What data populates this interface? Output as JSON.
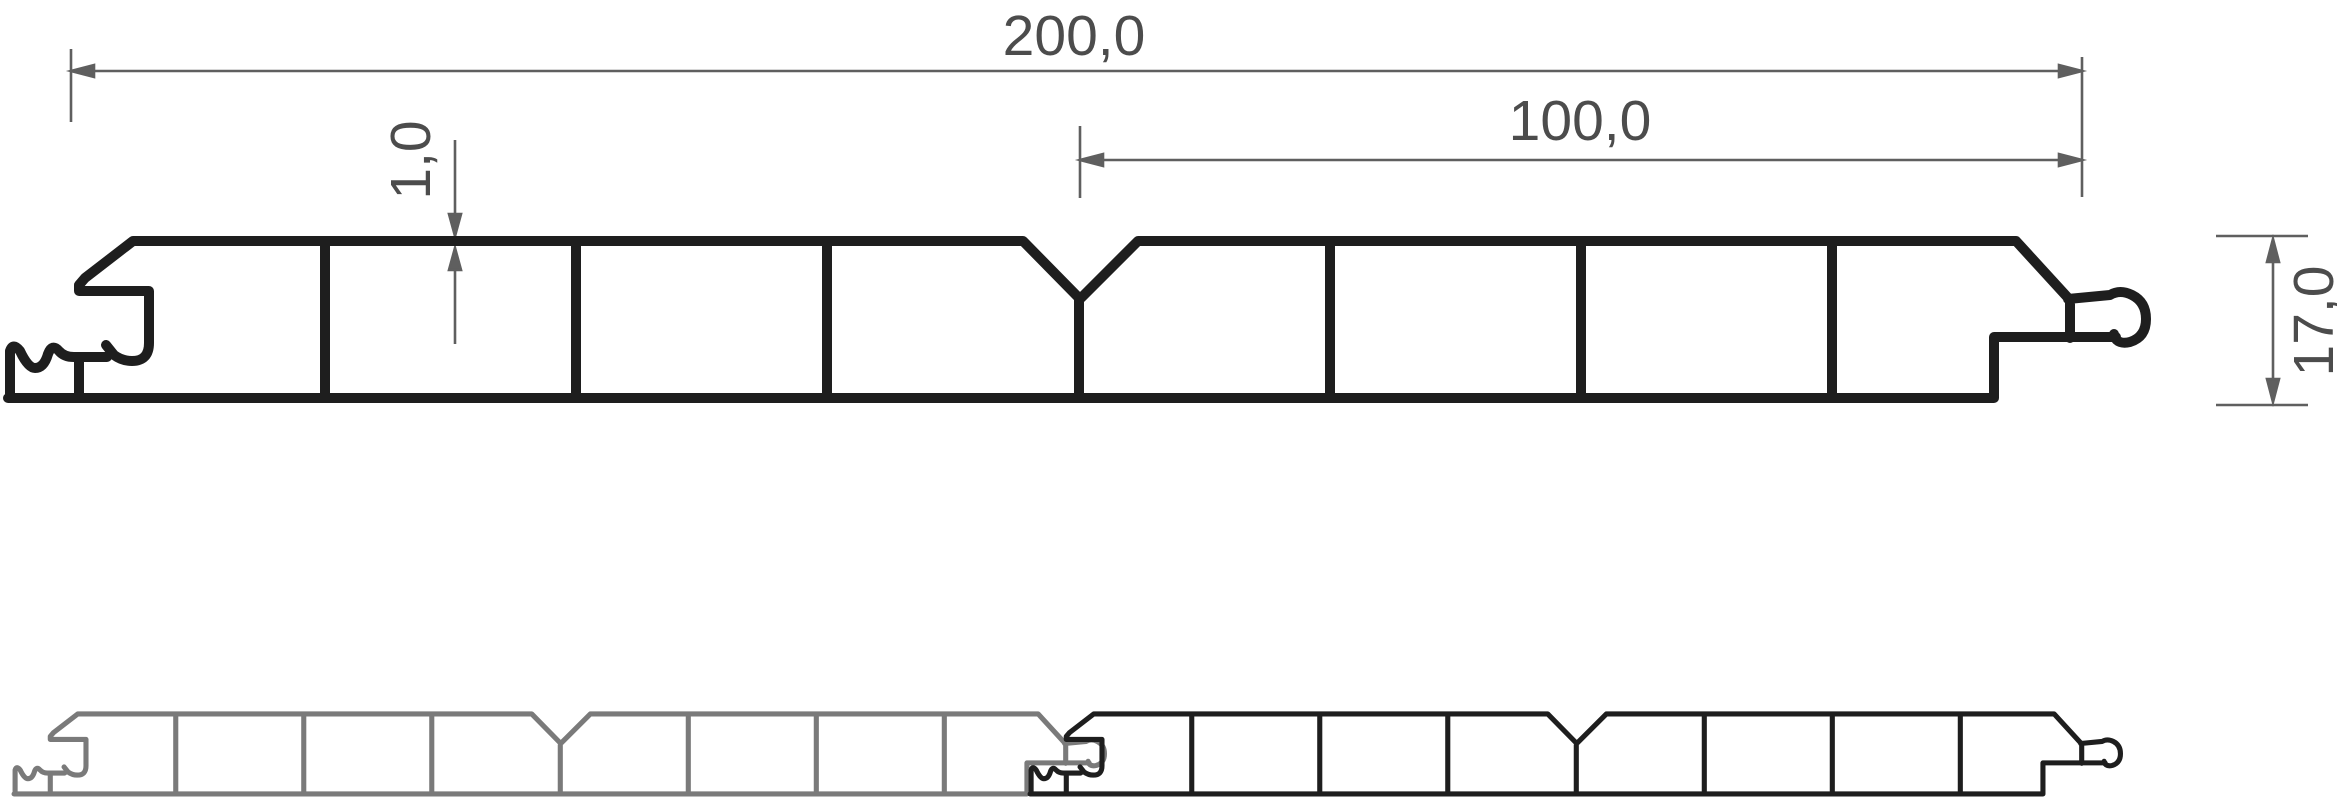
{
  "drawing": {
    "type": "technical-cross-section",
    "subject": "hollow-panel-cladding-profile",
    "dimensions": {
      "total_width_label": "200,0",
      "half_width_label": "100,0",
      "wall_thickness_label": "1,0",
      "height_label": "17,0"
    },
    "colors": {
      "main_outline": "#1e1e1e",
      "secondary_outline": "#7a7a7a",
      "dimension_line": "#5f5f5f",
      "dimension_text": "#4c4c4c"
    }
  }
}
